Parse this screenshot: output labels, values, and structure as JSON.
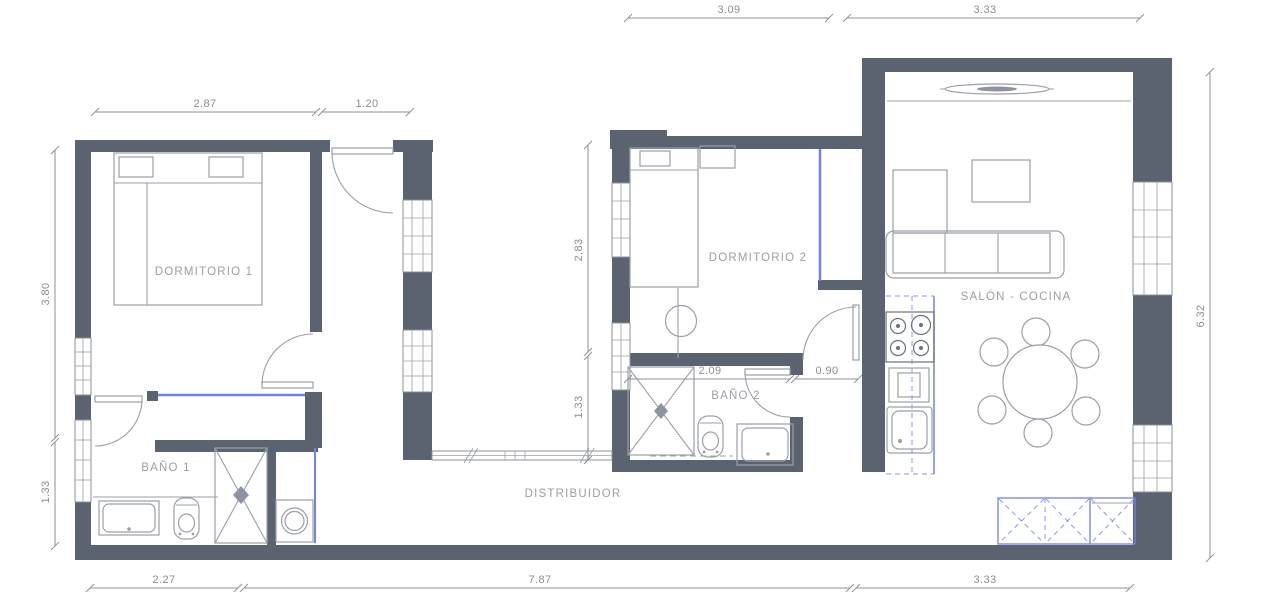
{
  "drawing": {
    "rooms": {
      "dormitorio1": "DORMITORIO 1",
      "banio1": "BAÑO 1",
      "dormitorio2": "DORMITORIO 2",
      "banio2": "BAÑO 2",
      "salon_cocina": "SALÓN - COCINA",
      "distribuidor": "DISTRIBUIDOR"
    },
    "dims": {
      "dorm2_top_width": "3.09",
      "salon_top_width": "3.33",
      "dorm1_width": "2.87",
      "entry_width": "1.20",
      "dorm1_height": "3.80",
      "banio1_height": "1.33",
      "dorm2_height": "2.83",
      "banio2_height": "1.33",
      "banio2_width": "2.09",
      "salon_door_width": "0.90",
      "salon_height": "6.32",
      "banio1_bottom_width": "2.27",
      "corridor_bottom_width": "7.87",
      "salon_bottom_width": "3.33"
    },
    "colors": {
      "wall": "#5c6370",
      "line": "#9aa0a8",
      "dim_text": "#8b8e92",
      "accent_blue": "#7680e8",
      "background": "#ffffff"
    }
  }
}
